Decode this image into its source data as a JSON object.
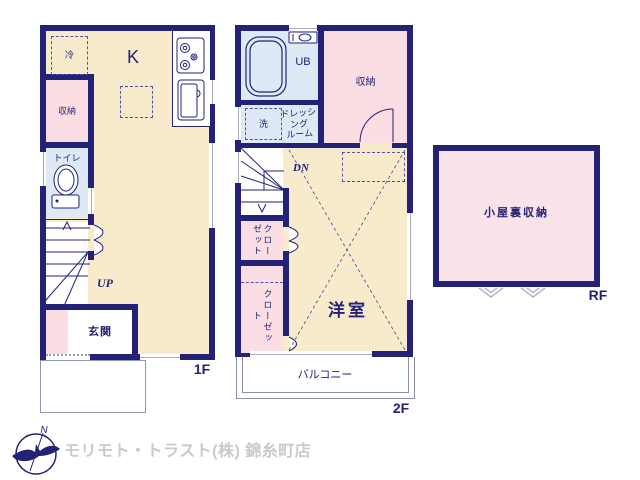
{
  "colors": {
    "wall": "#232277",
    "room_beige": "#f7ebcb",
    "room_pink": "#fadee3",
    "room_blue": "#dfe9f6",
    "attic_pink": "#f9e3e9",
    "window_gray": "#a8adc4",
    "company_text": "#cacaca"
  },
  "floor1": {
    "label": "1F",
    "kitchen": "K",
    "fridge": "冷",
    "storage": "収納",
    "toilet": "トイレ",
    "stairs_up": "UP",
    "entrance": "玄関"
  },
  "floor2": {
    "label": "2F",
    "unit_bath": "UB",
    "storage": "収納",
    "washer": "洗",
    "dressing_room": "ドレッシング\nルーム",
    "stairs_down": "DN",
    "closet_upper": "クローゼット",
    "closet_lower": "クローゼット",
    "western_room": "洋室",
    "balcony": "バルコニー"
  },
  "roof": {
    "label": "RF",
    "attic_storage": "小屋裏収納"
  },
  "branding": {
    "compass_north": "N",
    "company": "モリモト・トラスト(株) 錦糸町店"
  }
}
